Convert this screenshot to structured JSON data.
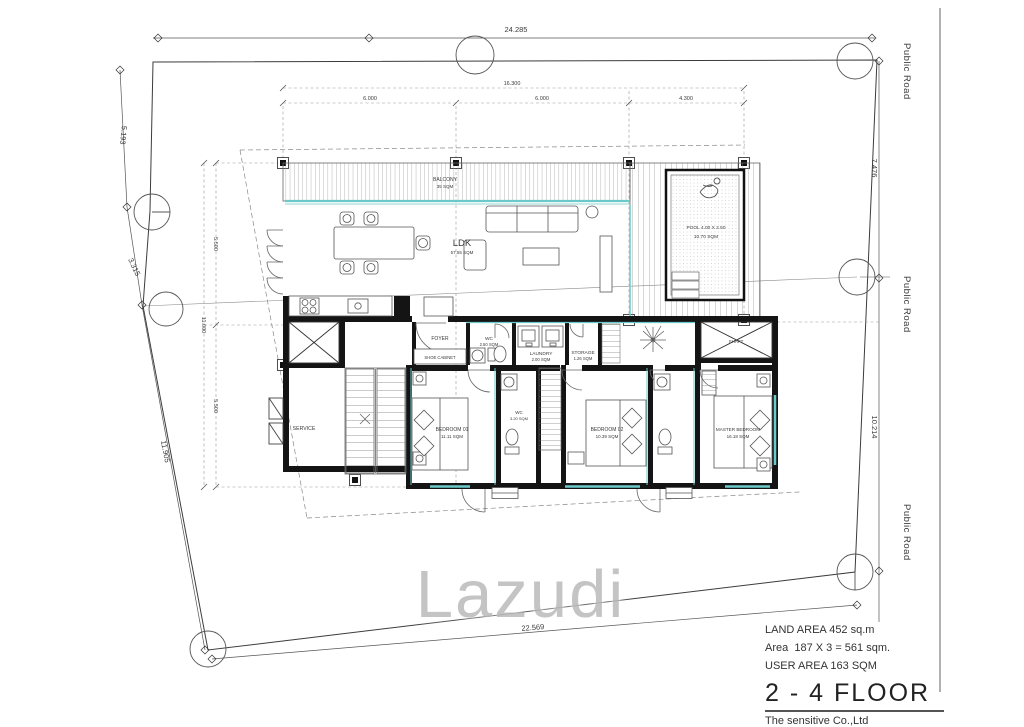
{
  "watermark": {
    "text": "Lazudi"
  },
  "site_dimensions": {
    "top": "24.285",
    "bottom": "22.569",
    "left_upper": "5.193",
    "left_mid": "3.315",
    "left_lower": "11.905",
    "right_upper": "7.476",
    "right_lower": "10.214"
  },
  "road_labels": [
    "Public Road",
    "Public Road",
    "Public Road"
  ],
  "grid_dimensions": {
    "top_overall": "16.300",
    "top_segments": [
      "6.000",
      "6.000",
      "4.300"
    ],
    "left_overall": "11.000",
    "left_segments": [
      "5.500",
      "5.500"
    ]
  },
  "rooms": {
    "balcony": {
      "name": "BALCONY",
      "area": "35 SQM"
    },
    "ldk": {
      "name": "LDK",
      "area": "57.55 SQM"
    },
    "pool": {
      "name": "POOL 4.00 X 2.50",
      "area": "10.70 SQM"
    },
    "foyer": {
      "name": "FOYER"
    },
    "shoe_cabinet": {
      "name": "SHOE CABINET"
    },
    "wc": {
      "name": "WC",
      "area": "2.50 SQM"
    },
    "laundry": {
      "name": "LAUNDRY",
      "area": "2.00 SQM"
    },
    "storage": {
      "name": "STORAGE",
      "area": "1.26 SQM"
    },
    "shaft": {
      "name": "SHAFT"
    },
    "service": {
      "name": "SERVICE"
    },
    "bedroom_01": {
      "name": "BEDROOM 01",
      "area": "11.11 SQM"
    },
    "bedroom_wc": {
      "name": "WC",
      "area": "3.20 SQM"
    },
    "bedroom_02": {
      "name": "BEDROOM 02",
      "area": "10.39 SQM"
    },
    "master_bedroom": {
      "name": "MASTER BEDROOM",
      "area": "16.18 SQM"
    }
  },
  "title_block": {
    "land_area": "LAND AREA 452 sq.m",
    "area_calc": "Area  187 X 3 = 561 sqm.",
    "user_area": "USER AREA 163 SQM",
    "floor_title": "2 - 4  FLOOR",
    "company": "The sensitive Co.,Ltd"
  },
  "colors": {
    "wall": "#141414",
    "glass": "#6cc9c9",
    "line": "#444444",
    "watermark": "#bdbdbd"
  }
}
